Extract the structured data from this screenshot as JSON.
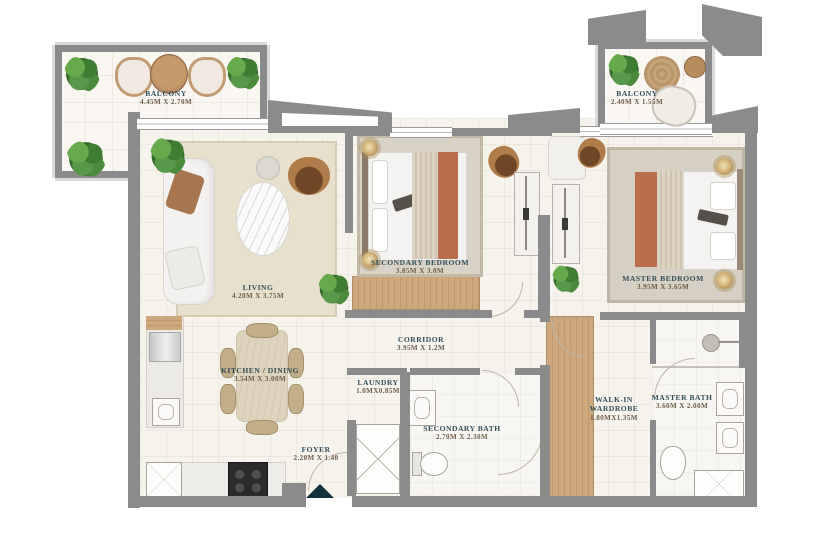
{
  "plan": {
    "title": "apartment-floor-plan",
    "rooms": [
      {
        "id": "balcony-left",
        "name": "BALCONY",
        "dims": "4.45M X 2.70M"
      },
      {
        "id": "balcony-right",
        "name": "BALCONY",
        "dims": "2.40M X 1.55M"
      },
      {
        "id": "living",
        "name": "LIVING",
        "dims": "4.20M X 3.75M"
      },
      {
        "id": "secondary-bedroom",
        "name": "SECONDARY BEDROOM",
        "dims": "3.85M X 3.0M"
      },
      {
        "id": "master-bedroom",
        "name": "MASTER BEDROOM",
        "dims": "3.95M X 3.65M"
      },
      {
        "id": "corridor",
        "name": "CORRIDOR",
        "dims": "3.95M X 1.2M"
      },
      {
        "id": "kitchen-dining",
        "name": "KITCHEN / DINING",
        "dims": "3.54M X 3.00M"
      },
      {
        "id": "laundry",
        "name": "LAUNDRY",
        "dims": "1.0MX0.85M"
      },
      {
        "id": "foyer",
        "name": "FOYER",
        "dims": "2.20M X 1.40"
      },
      {
        "id": "secondary-bath",
        "name": "SECONDARY BATH",
        "dims": "2.70M X 2.30M"
      },
      {
        "id": "walkin-wardrobe",
        "name": "WALK-IN WARDROBE",
        "dims": "1.80MX1.35M"
      },
      {
        "id": "master-bath",
        "name": "MASTER BATH",
        "dims": "3.60M X 2.00M"
      }
    ],
    "icons": {
      "entrance-marker": "solid teal triangle pointing up at unit entry",
      "plant-icon": "green potted plant",
      "ceiling-light-icon": "gold dome light",
      "shower-head-icon": "gray shower head"
    },
    "colors": {
      "wall": "#8b8b8b",
      "floor": "#f6f2ec",
      "room_name_text": "#33505a",
      "dims_text": "#6e5d49",
      "terracotta_bedding": "#b96f4c",
      "wood_floor": "#c9a478",
      "plant_green": "#4f9340",
      "entrance_marker": "#14323b",
      "gold_light": "#c9a96a"
    }
  }
}
